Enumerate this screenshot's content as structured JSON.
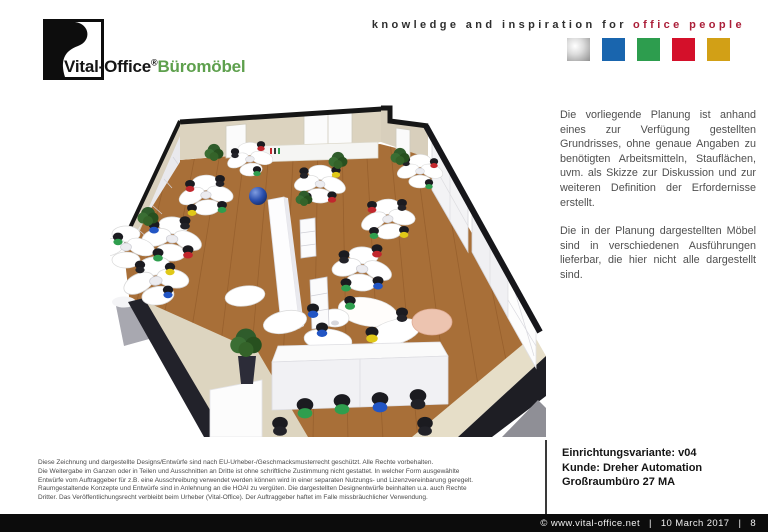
{
  "brand": {
    "logo_text_1": "Vital-",
    "logo_text_2": "Office",
    "logo_reg": "®",
    "logo_text_3": "Büromöbel",
    "tagline_black": "knowledge and inspiration for",
    "tagline_red": "office people",
    "squares": [
      {
        "name": "silver",
        "color": "#b9b9b9"
      },
      {
        "name": "blue",
        "color": "#1965ae"
      },
      {
        "name": "green",
        "color": "#2d9d4e"
      },
      {
        "name": "red",
        "color": "#d4102a"
      },
      {
        "name": "gold",
        "color": "#d2a016"
      }
    ]
  },
  "description": {
    "paragraph_1": "Die vorliegende Planung ist anhand eines zur Verfügung gestellten Grundrisses, ohne genaue Angaben zu benötigten Arbeitsmitteln, Stauflächen, uvm. als Skizze zur Diskussion und zur weiteren Definition der Erfordernisse erstellt.",
    "paragraph_2": "Die in der Planung dargestellten Möbel sind in verschiedenen Ausführungen lieferbar, die hier nicht alle dargestellt sind."
  },
  "legal_lines": [
    "Diese Zeichnung und dargestellte Designs/Entwürfe sind nach EU-Urheber-/Geschmacksmusterrecht geschützt. Alle Rechte vorbehalten.",
    "Die Weitergabe im Ganzen oder in Teilen und Ausschnitten an Dritte ist ohne schriftliche Zustimmung nicht gestattet. In welcher Form ausgewählte",
    "Entwürfe vom Auftraggeber für z.B. eine Ausschreibung verwendet werden können wird in einer separaten Nutzungs- und Lizenzvereinbarung geregelt.",
    "Raumgestaltende Konzepte und Entwürfe sind in Anlehnung an die HOAI zu vergüten. Die dargestellten Designentwürfe beinhalten u.a. auch Rechte",
    "Dritter. Das Veröffentlichungsrecht verbleibt beim Urheber (Vital-Office). Der Auftraggeber haftet im Falle missbräuchlicher Verwendung."
  ],
  "project": {
    "variant": "Einrichtungsvariante: v04",
    "customer": "Kunde: Dreher Automation",
    "room": "Großraumbüro 27 MA"
  },
  "footer": {
    "copyright": "© www.vital-office.net",
    "separator": "|",
    "date": "10 March 2017",
    "page": "8"
  },
  "illustration": {
    "alt": "3D-Planung Großraumbüro mit Arbeitsplatz-Clustern",
    "palette": {
      "floor": "#a86f38",
      "wall_beige": "#dcd3bf",
      "wall_panel": "#e9e9ed",
      "furniture_white": "#ffffff",
      "plant_green": "#2f5c2b",
      "ball_blue": "#2a4fae",
      "chair_red": "#c1272d",
      "chair_green": "#2f9e4e",
      "chair_blue": "#2255c4",
      "chair_yellow": "#e0c818"
    }
  }
}
